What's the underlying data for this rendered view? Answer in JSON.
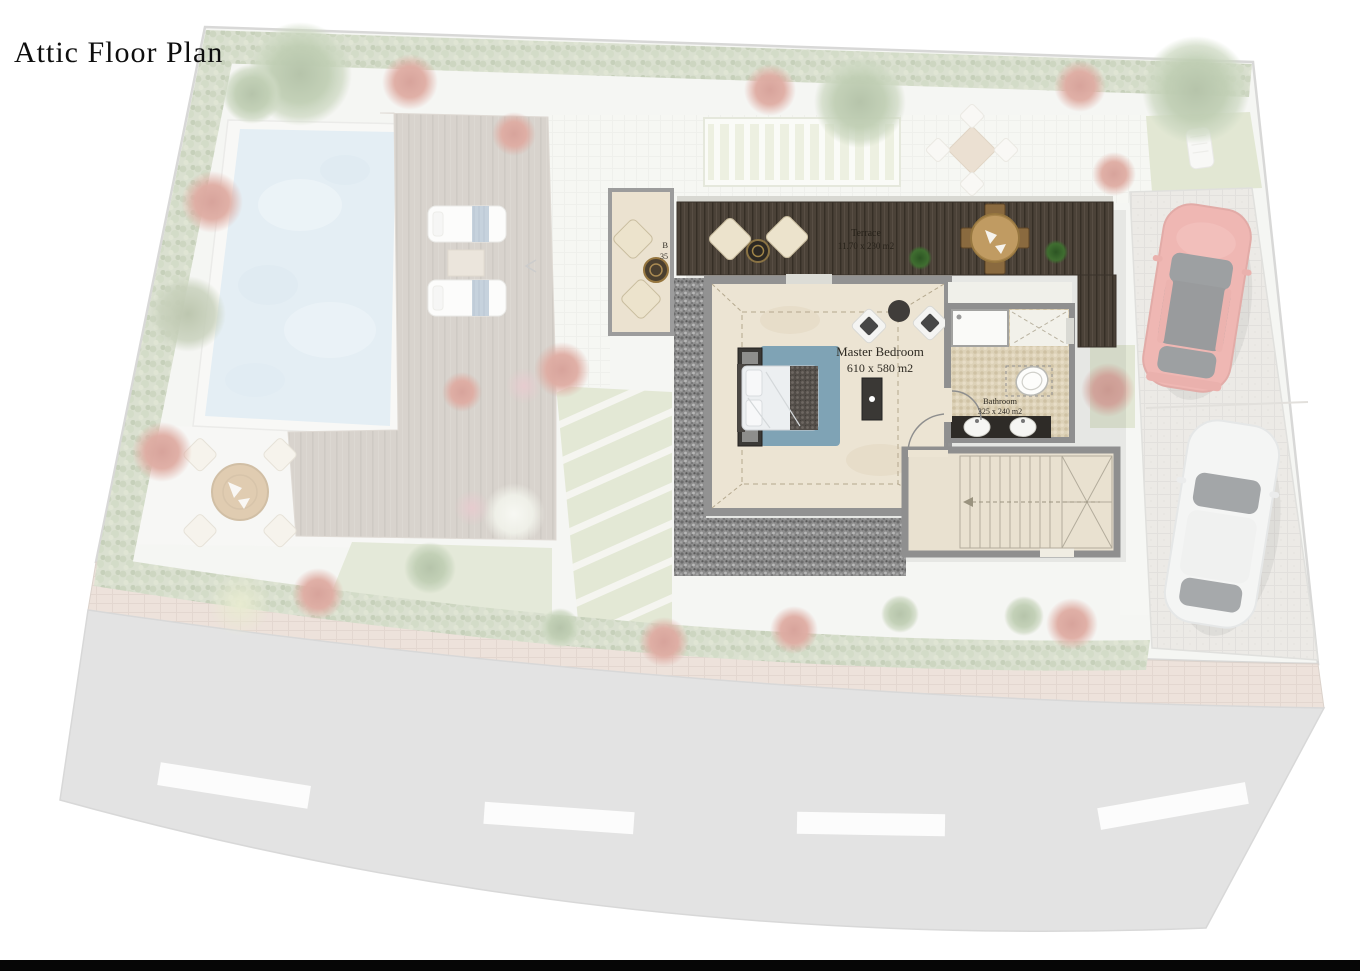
{
  "title": "Attic Floor Plan",
  "rooms": {
    "terrace": {
      "name": "Terrace",
      "dims": "11.70 x 230  m2"
    },
    "master_bedroom": {
      "name": "Master Bedroom",
      "dims": "610 x 580 m2"
    },
    "bathroom": {
      "name": "Bathroom",
      "dims": "325 x 240 m2"
    },
    "balcony": {
      "partial_line1": "B",
      "partial_line2": "35"
    }
  },
  "colors": {
    "pool_water": "#cbdfeb",
    "deck_wood": "#b2a89c",
    "terrace_wood": "#4b4238",
    "bedroom_floor": "#ece4d3",
    "bathroom_floor": "#ddd2b8",
    "wall": "#929292",
    "rug": "#7fa3b5",
    "lawn": "#c8d2ad",
    "hedge": "#b6c2a2",
    "road_asphalt": "#c9c9c9",
    "sidewalk_brick": "#dcc6b9",
    "car_red": "#e0716a",
    "car_white": "#ebeceb",
    "gravel": "#8e8e8e"
  }
}
